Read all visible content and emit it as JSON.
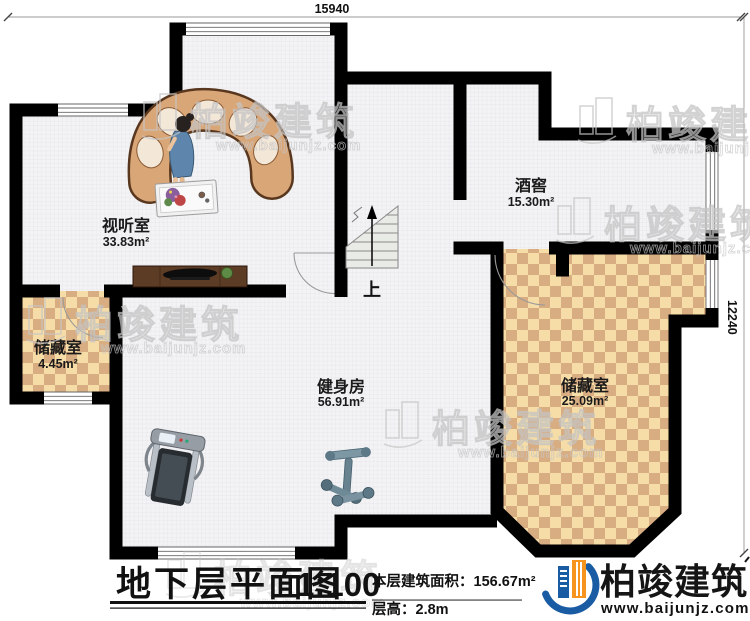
{
  "plan": {
    "title": "地下层平面图",
    "scale": "1:100",
    "building_area": "本层建筑面积：156.67m²",
    "floor_height": "层高：2.8m",
    "dimensions": {
      "top": "15940",
      "right": "12240"
    },
    "stairs_label": "上",
    "rooms": [
      {
        "id": "media-room",
        "name": "视听室",
        "area": "33.83m²"
      },
      {
        "id": "wine-cellar",
        "name": "酒窖",
        "area": "15.30m²"
      },
      {
        "id": "storage-small",
        "name": "储藏室",
        "area": "4.45m²"
      },
      {
        "id": "gym",
        "name": "健身房",
        "area": "56.91m²"
      },
      {
        "id": "storage-large",
        "name": "储藏室",
        "area": "25.09m²"
      }
    ]
  },
  "branding": {
    "name": "柏竣建筑",
    "url": "www.baijunjz.com"
  },
  "watermark": {
    "text": "柏竣建筑",
    "url": "www.baijunjz.com"
  },
  "colors": {
    "wall": "#000000",
    "floor_grid": "#f3f3f5",
    "checker_light": "#f6dca6",
    "checker_dark": "#d8ad82",
    "logo_blue": "#1a5ca4",
    "logo_orange": "#f7941d",
    "sofa_tan": "#d9a678",
    "cabinet_brown": "#5d3c26"
  }
}
